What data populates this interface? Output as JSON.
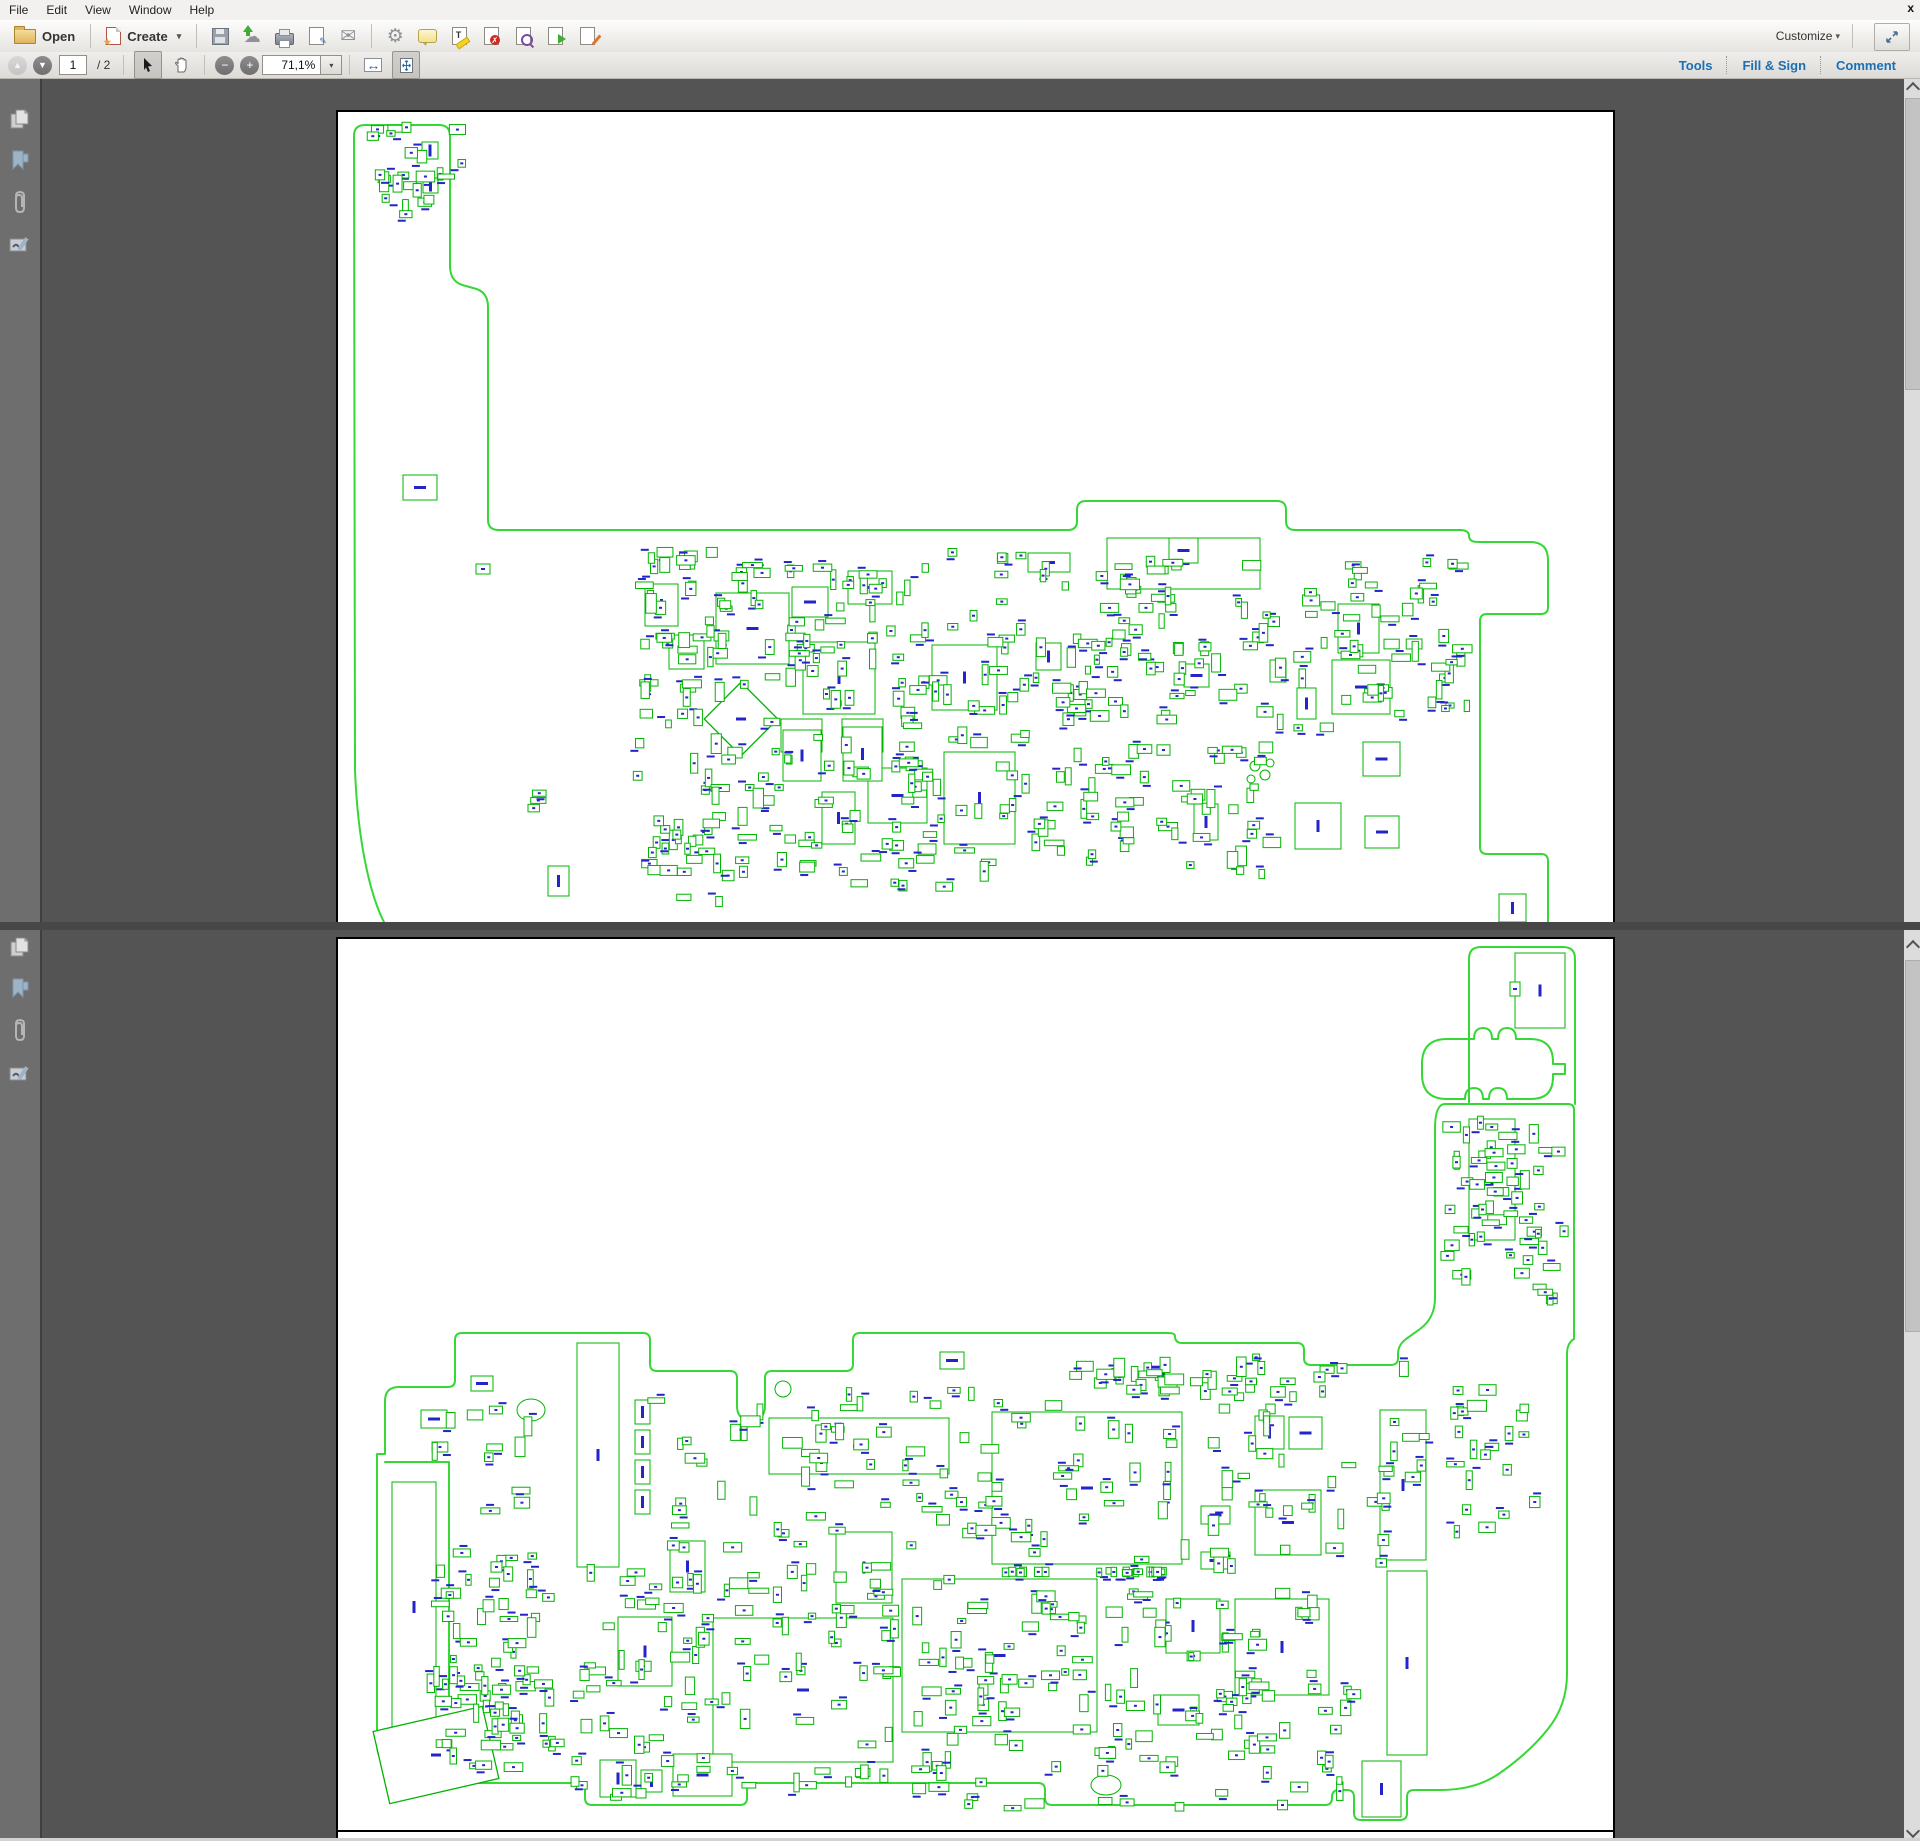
{
  "menu": {
    "items": [
      "File",
      "Edit",
      "View",
      "Window",
      "Help"
    ],
    "close_label": "x"
  },
  "toolbar": {
    "open_label": "Open",
    "create_label": "Create",
    "customize_label": "Customize",
    "caret_glyph": "▾",
    "icons": [
      "open-folder-icon",
      "create-pdf-icon",
      "save-icon",
      "cloud-upload-icon",
      "print-icon",
      "sign-document-icon",
      "email-icon",
      "gear-icon",
      "comment-bubble-icon",
      "highlight-text-icon",
      "pdf-delete-icon",
      "pdf-search-icon",
      "pdf-export-icon",
      "pdf-edit-icon",
      "expand-window-icon"
    ],
    "glyphs": {
      "cloud": "☁",
      "mail": "✉",
      "gear": "⚙",
      "pen": "✎",
      "cross": "✗",
      "text_t": "T",
      "expand": "⇲"
    }
  },
  "nav": {
    "prev_glyph": "▲",
    "next_glyph": "▼",
    "page_value": "1",
    "page_total_label": "/ 2",
    "zoom_out_glyph": "−",
    "zoom_in_glyph": "+",
    "zoom_value": "71,1%",
    "fit_width_glyph": "↔",
    "right_tabs": [
      "Tools",
      "Fill & Sign",
      "Comment"
    ]
  },
  "sidebar": {
    "icons": [
      "page-thumbnails-icon",
      "bookmarks-icon",
      "attachments-icon",
      "signature-icon"
    ]
  },
  "colors": {
    "accent_blue": "#1b6fb5",
    "content_bg": "#545454",
    "sidebar_bg": "#6e6e6e",
    "board_outline_green": "#35d835",
    "component_green": "#00b400",
    "label_blue": "#2424c8",
    "page_white": "#ffffff"
  },
  "pcb": {
    "pages": [
      {
        "name": "board-top-side",
        "outlines": [
          "M383,922 C370,898 356,846 353,768 L352,134 Q352,123 363,123 L437,123 Q448,123 448,134 L448,264 Q448,281 464,284 L471,286 Q486,289 486,305 L486,518 Q486,528 497,528 L1066,528 Q1075,528 1075,519 L1075,508 Q1075,499 1084,499 L1275,499 Q1284,499 1284,508 L1284,519 Q1284,528 1293,528 L1458,528 Q1467,528 1467,534 Q1467,540 1476,540 L1528,540 Q1546,540 1546,558 L1546,605 Q1546,612 1539,612 L1485,612 Q1478,612 1478,619 L1478,845 Q1478,852 1485,852 L1539,852 Q1546,852 1546,859 L1546,922"
        ],
        "extra_lines": [],
        "ellipses": [
          [
            1253,
            764,
            5,
            5
          ],
          [
            1263,
            773,
            5,
            5
          ],
          [
            1249,
            777,
            4,
            4
          ],
          [
            1268,
            761,
            4,
            4
          ]
        ],
        "comps": [
          [
            643,
            582,
            33,
            42
          ],
          [
            714,
            591,
            73,
            71
          ],
          [
            667,
            633,
            35,
            34
          ],
          [
            790,
            585,
            36,
            30
          ],
          [
            846,
            569,
            44,
            33
          ],
          [
            801,
            640,
            72,
            72
          ],
          [
            930,
            643,
            65,
            65
          ],
          [
            779,
            717,
            41,
            33
          ],
          [
            840,
            717,
            41,
            33
          ],
          [
            942,
            750,
            71,
            92
          ],
          [
            866,
            766,
            59,
            55
          ],
          [
            820,
            790,
            33,
            52
          ],
          [
            781,
            728,
            38,
            51
          ],
          [
            841,
            725,
            39,
            54
          ],
          [
            1026,
            551,
            42,
            19
          ],
          [
            1105,
            536,
            153,
            51
          ],
          [
            1167,
            536,
            29,
            25
          ],
          [
            1034,
            641,
            25,
            27
          ],
          [
            1336,
            602,
            41,
            49
          ],
          [
            1330,
            658,
            58,
            54
          ],
          [
            1295,
            686,
            19,
            31
          ],
          [
            1361,
            740,
            37,
            34
          ],
          [
            1293,
            801,
            46,
            46
          ],
          [
            1363,
            814,
            34,
            32
          ],
          [
            1192,
            802,
            24,
            36
          ],
          [
            1182,
            662,
            25,
            23
          ],
          [
            1268,
            658,
            16,
            22
          ],
          [
            1497,
            892,
            27,
            28
          ],
          [
            401,
            473,
            34,
            25
          ],
          [
            546,
            864,
            21,
            30
          ],
          [
            474,
            562,
            14,
            10
          ],
          [
            420,
            140,
            16,
            17
          ],
          [
            421,
            176,
            15,
            15
          ]
        ],
        "rot_comps": [
          {
            "cx": 739,
            "cy": 717,
            "w": 52,
            "h": 52,
            "rot": 45
          }
        ],
        "clusters": [
          {
            "x": 365,
            "y": 118,
            "w": 100,
            "h": 100,
            "n": 24,
            "seed": 11
          },
          {
            "x": 628,
            "y": 545,
            "w": 400,
            "h": 345,
            "n": 225,
            "seed": 12
          },
          {
            "x": 1028,
            "y": 548,
            "w": 260,
            "h": 330,
            "n": 135,
            "seed": 13
          },
          {
            "x": 1288,
            "y": 556,
            "w": 185,
            "h": 190,
            "n": 55,
            "seed": 14
          },
          {
            "x": 663,
            "y": 816,
            "w": 60,
            "h": 92,
            "n": 9,
            "seed": 15
          },
          {
            "x": 523,
            "y": 788,
            "w": 30,
            "h": 28,
            "n": 3,
            "seed": 16
          }
        ]
      },
      {
        "name": "board-bottom-side",
        "outlines": [
          "M1433,1127 L1433,1296 Q1433,1316 1418,1327 L1404,1337 Q1396,1343 1396,1352 L1396,1356 Q1396,1363 1389,1363 L1309,1363 Q1302,1363 1302,1356 L1302,1348 Q1302,1341 1295,1341 L1180,1341 Q1173,1341 1173,1334 Q1173,1331 1166,1331 L858,1331 Q851,1331 851,1338 L851,1362 Q851,1369 844,1369 L770,1369 Q763,1369 763,1376 L763,1404 Q763,1418 749,1418 Q735,1418 735,1404 L735,1376 Q735,1369 728,1369 L655,1369 Q648,1369 648,1362 L648,1338 Q648,1331 641,1331 L460,1331 Q453,1331 453,1338 L453,1378 Q453,1385 446,1385 L397,1385 Q383,1385 383,1399 L383,1452 L375,1452 L375,1742 Q375,1756 385,1766 L396,1775 Q404,1781 415,1781 L576,1781 Q583,1781 583,1788 L583,1796 Q583,1803 590,1803 L738,1803 Q745,1803 745,1796 L745,1788 Q745,1781 752,1781 L1036,1781 Q1043,1781 1043,1788 L1043,1796 Q1043,1803 1050,1803 L1323,1803 Q1330,1803 1330,1796 L1330,1795 Q1330,1788 1337,1788 L1345,1788 Q1352,1788 1352,1795 L1352,1811 Q1352,1818 1359,1818 L1398,1818 Q1405,1818 1405,1811 L1405,1795 Q1405,1788 1412,1788 L1438,1788 Q1472,1788 1495,1773 Q1526,1752 1546,1727 Q1565,1703 1565,1672 L1565,1352 Q1565,1341 1572,1337 L1572,1108 Q1572,1102 1566,1102 L1443,1102 Q1433,1102 1433,1127 Z",
          "M1467,1102 L1467,957 Q1467,945 1479,945 L1561,945 Q1573,945 1573,957 L1573,1102",
          "M1445,1097 Q1420,1097 1420,1072 L1420,1062 Q1420,1037 1445,1037 L1472,1037 Q1472,1026 1481,1026 Q1490,1026 1490,1037 L1496,1037 Q1496,1026 1505,1026 Q1514,1026 1514,1037 L1528,1037 Q1551,1037 1551,1060 L1551,1062 L1563,1062 L1563,1072 L1551,1072 L1551,1075 Q1551,1097 1529,1097 L1509,1097 L1505,1097 Q1505,1086 1496,1086 Q1487,1086 1487,1097 L1481,1097 Q1481,1086 1472,1086 Q1463,1086 1463,1097 Z",
          "M383,1460 L447,1460 L447,1695"
        ],
        "extra_lines": [],
        "ellipses": [
          [
            529,
            1408,
            14,
            11
          ],
          [
            1104,
            1783,
            15,
            10
          ],
          [
            781,
            1387,
            8,
            8
          ]
        ],
        "comps": [
          [
            1513,
            951,
            50,
            75
          ],
          [
            1508,
            980,
            10,
            14
          ],
          [
            1467,
            1117,
            46,
            121
          ],
          [
            575,
            1341,
            42,
            224
          ],
          [
            767,
            1416,
            180,
            56
          ],
          [
            834,
            1530,
            56,
            71
          ],
          [
            668,
            1539,
            35,
            51
          ],
          [
            616,
            1615,
            54,
            69
          ],
          [
            900,
            1584,
            35,
            46
          ],
          [
            990,
            1410,
            190,
            152
          ],
          [
            900,
            1577,
            195,
            153
          ],
          [
            711,
            1616,
            180,
            144
          ],
          [
            1164,
            1597,
            54,
            54
          ],
          [
            1233,
            1597,
            94,
            96
          ],
          [
            1253,
            1488,
            66,
            65
          ],
          [
            1199,
            1504,
            29,
            18
          ],
          [
            1199,
            1550,
            29,
            17
          ],
          [
            1287,
            1415,
            33,
            32
          ],
          [
            1253,
            1414,
            29,
            33
          ],
          [
            1156,
            1693,
            41,
            30
          ],
          [
            1378,
            1408,
            46,
            150
          ],
          [
            1385,
            1569,
            40,
            184
          ],
          [
            1360,
            1759,
            39,
            56
          ],
          [
            598,
            1758,
            36,
            37
          ],
          [
            671,
            1752,
            59,
            42
          ],
          [
            639,
            1768,
            21,
            22
          ],
          [
            390,
            1480,
            44,
            250
          ],
          [
            419,
            1408,
            26,
            18
          ],
          [
            469,
            1374,
            22,
            15
          ],
          [
            938,
            1350,
            24,
            17
          ],
          [
            633,
            1398,
            15,
            24
          ],
          [
            633,
            1428,
            15,
            24
          ],
          [
            633,
            1458,
            15,
            24
          ],
          [
            633,
            1488,
            15,
            24
          ]
        ],
        "rot_comps": [
          {
            "cx": 434,
            "cy": 1753,
            "w": 112,
            "h": 74,
            "rot": -13
          }
        ],
        "clusters": [
          {
            "x": 1437,
            "y": 1112,
            "w": 130,
            "h": 195,
            "n": 55,
            "seed": 21
          },
          {
            "x": 424,
            "y": 1545,
            "w": 140,
            "h": 225,
            "n": 75,
            "seed": 22
          },
          {
            "x": 565,
            "y": 1560,
            "w": 390,
            "h": 240,
            "n": 120,
            "seed": 23
          },
          {
            "x": 940,
            "y": 1585,
            "w": 420,
            "h": 225,
            "n": 130,
            "seed": 24
          },
          {
            "x": 640,
            "y": 1380,
            "w": 330,
            "h": 175,
            "n": 55,
            "seed": 25
          },
          {
            "x": 960,
            "y": 1345,
            "w": 470,
            "h": 230,
            "n": 85,
            "seed": 26
          },
          {
            "x": 1432,
            "y": 1380,
            "w": 125,
            "h": 185,
            "n": 22,
            "seed": 27
          },
          {
            "x": 995,
            "y": 1565,
            "w": 175,
            "h": 10,
            "n": 22,
            "seed": 28,
            "minw": 5,
            "maxw": 8,
            "minh": 8,
            "maxh": 10
          },
          {
            "x": 1090,
            "y": 1355,
            "w": 260,
            "h": 45,
            "n": 30,
            "seed": 29
          },
          {
            "x": 425,
            "y": 1390,
            "w": 120,
            "h": 130,
            "n": 12,
            "seed": 31
          }
        ]
      }
    ]
  }
}
